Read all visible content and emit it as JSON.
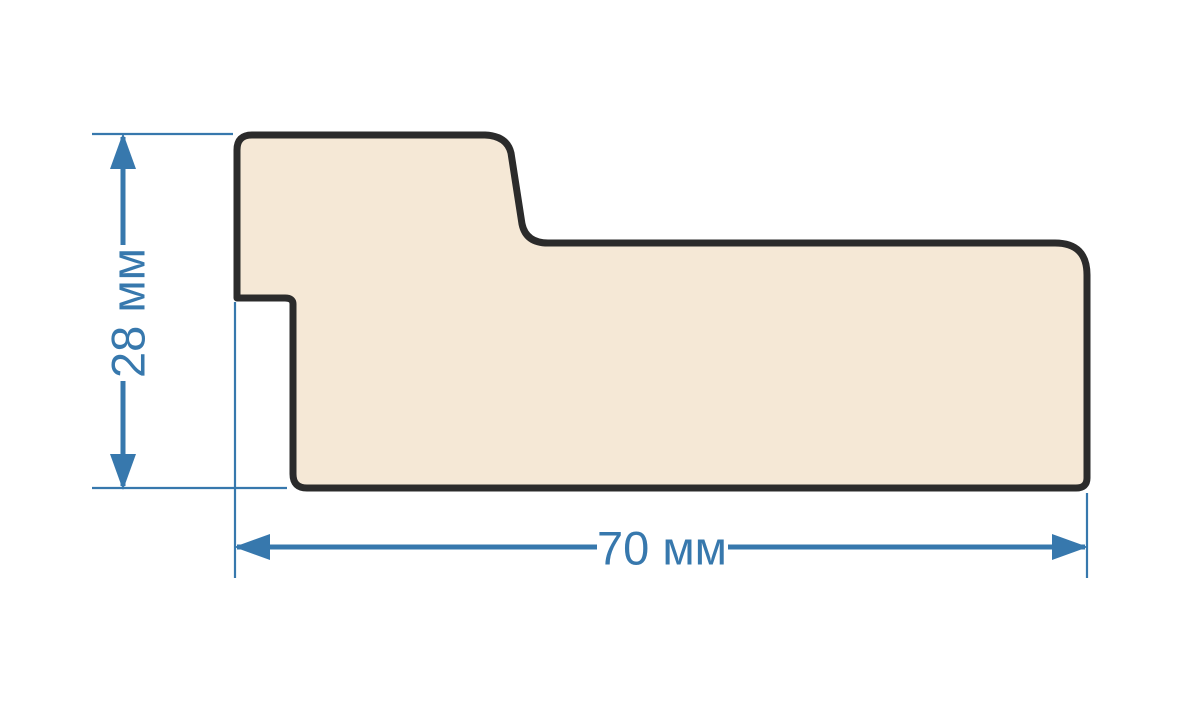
{
  "diagram": {
    "type": "technical-cross-section",
    "subject": "molding-profile",
    "dimensions": {
      "height": {
        "label": "28 мм",
        "value": 28,
        "unit": "мм"
      },
      "width": {
        "label": "70 мм",
        "value": 70,
        "unit": "мм"
      }
    },
    "colors": {
      "dimension_blue": "#3778AD",
      "profile_fill": "#F5E8D6",
      "profile_outline": "#2B2B2B",
      "background": "#FFFFFF"
    }
  }
}
